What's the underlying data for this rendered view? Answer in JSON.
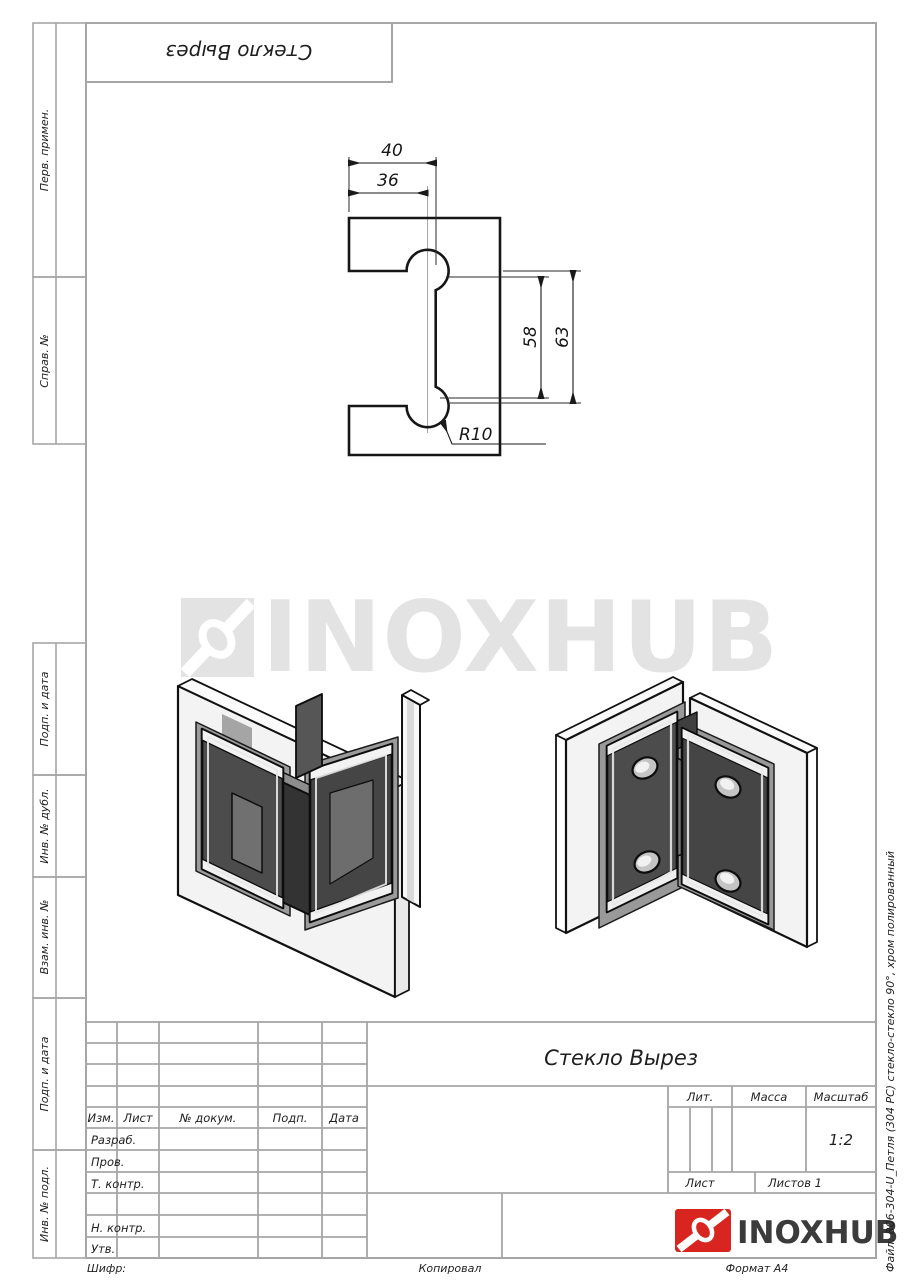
{
  "sheet": {
    "stamp_top": "Стекло Вырез",
    "watermark_text": "INOXHUB",
    "side_note": "Файл: 806-304-U_Петля (304 PC) стекло-стекло 90°, хром полированный",
    "footer_left": "Шифр:",
    "footer_center": "Копировал",
    "footer_right": "Формат А4"
  },
  "margin_labels": {
    "perv": "Перв. примен.",
    "sprav": "Справ. №",
    "podp1": "Подп. и дата",
    "inv_dubl": "Инв. № дубл.",
    "vzam": "Взам. инв. №",
    "podp2": "Подп. и дата",
    "inv_podl": "Инв. № подл."
  },
  "dims": {
    "w_outer": "40",
    "w_inner": "36",
    "h_inner": "58",
    "h_outer": "63",
    "radius": "R10"
  },
  "title_block": {
    "doc_title": "Стекло Вырез",
    "col_izm": "Изм.",
    "col_list": "Лист",
    "col_ndok": "№ докум.",
    "col_podp": "Подп.",
    "col_data": "Дата",
    "row_razrab": "Разраб.",
    "row_prov": "Пров.",
    "row_tkontr": "Т. контр.",
    "row_nkontr": "Н. контр.",
    "row_utv": "Утв.",
    "lit": "Лит.",
    "massa": "Масса",
    "masshtab": "Масштаб",
    "scale": "1:2",
    "list": "Лист",
    "listov": "Листов 1",
    "brand": "INOXHUB"
  },
  "colors": {
    "brand_red": "#d9251f",
    "line_gray": "#a6a6a6",
    "ink": "#1a1a1a",
    "watermark": "#e3e3e3"
  }
}
